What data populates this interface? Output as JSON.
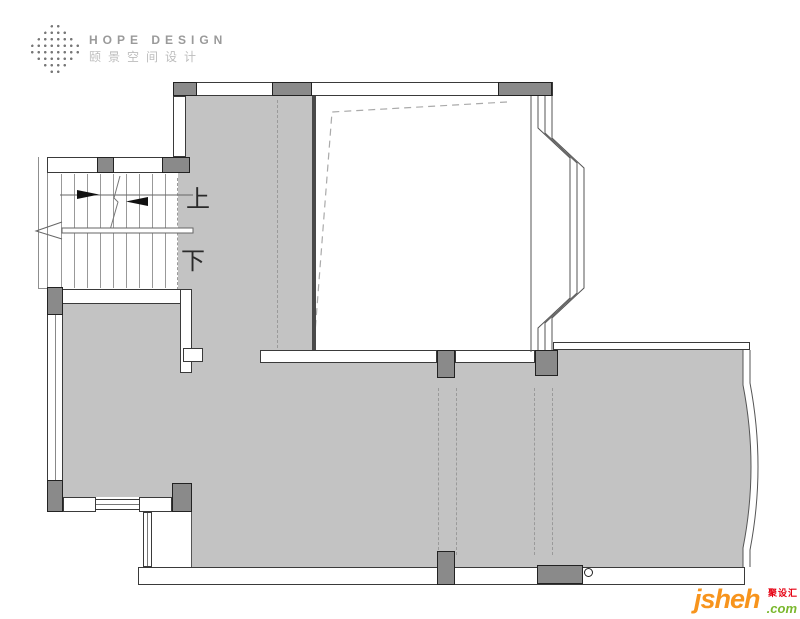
{
  "logo": {
    "title": "HOPE DESIGN",
    "subtitle": "颐景空间设计"
  },
  "stairs": {
    "up_label": "上",
    "down_label": "下"
  },
  "watermark": {
    "site": "jsheh",
    "tld": ".com",
    "cn_name": "聚设汇"
  },
  "colors": {
    "room_fill": "#c3c3c3",
    "column_fill": "#8a8a8a",
    "wall_line": "#3a3a3a",
    "dashed_line": "#9a9a9a",
    "logo_text": "#9a9a9a",
    "logo_subtext": "#bdbdbd",
    "watermark_orange": "#f7941d",
    "watermark_green": "#7ab82e",
    "watermark_red": "#e60012"
  }
}
